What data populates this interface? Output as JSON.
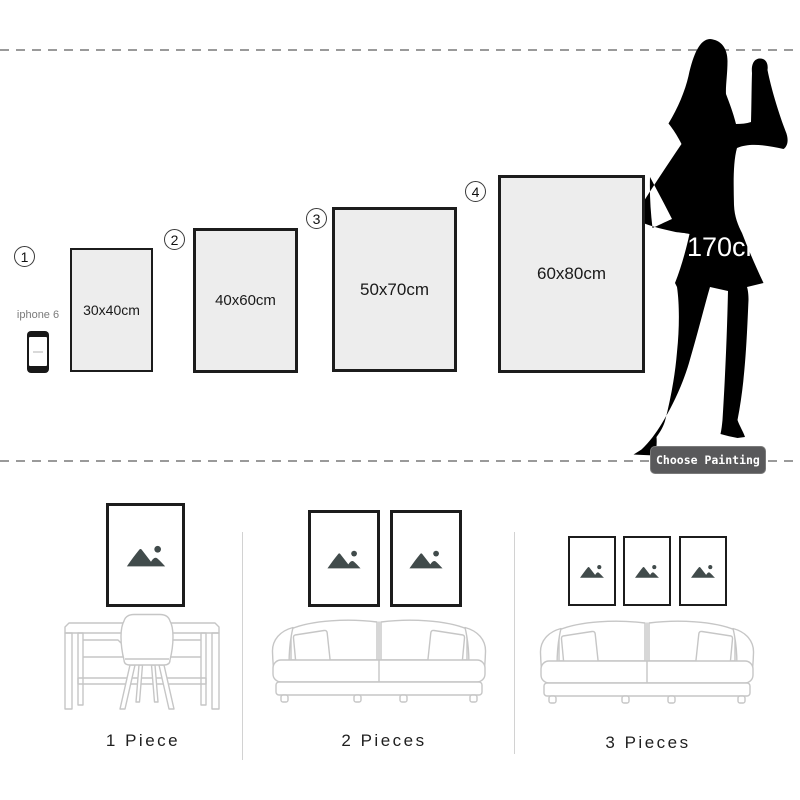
{
  "size_guide": {
    "sizes": [
      {
        "number": "1",
        "label": "30x40cm"
      },
      {
        "number": "2",
        "label": "40x60cm"
      },
      {
        "number": "3",
        "label": "50x70cm"
      },
      {
        "number": "4",
        "label": "60x80cm"
      }
    ],
    "phone_label": "iphone 6",
    "person_height": "170cm",
    "choose_button_label": "Choose Painting"
  },
  "room_scenes": [
    {
      "label": "1 Piece",
      "pieces": 1,
      "furniture": "desk-and-chair"
    },
    {
      "label": "2 Pieces",
      "pieces": 2,
      "furniture": "sofa"
    },
    {
      "label": "3 Pieces",
      "pieces": 3,
      "furniture": "sofa"
    }
  ],
  "colors": {
    "frame_fill": "#ededed",
    "frame_border": "#1c1c1c",
    "dashed_line": "#9a9a9a",
    "silhouette": "#000000",
    "button_background": "#59595b",
    "button_text": "#ffffff",
    "placeholder_icon": "#414b4b",
    "furniture_line": "#c6c6c6"
  }
}
